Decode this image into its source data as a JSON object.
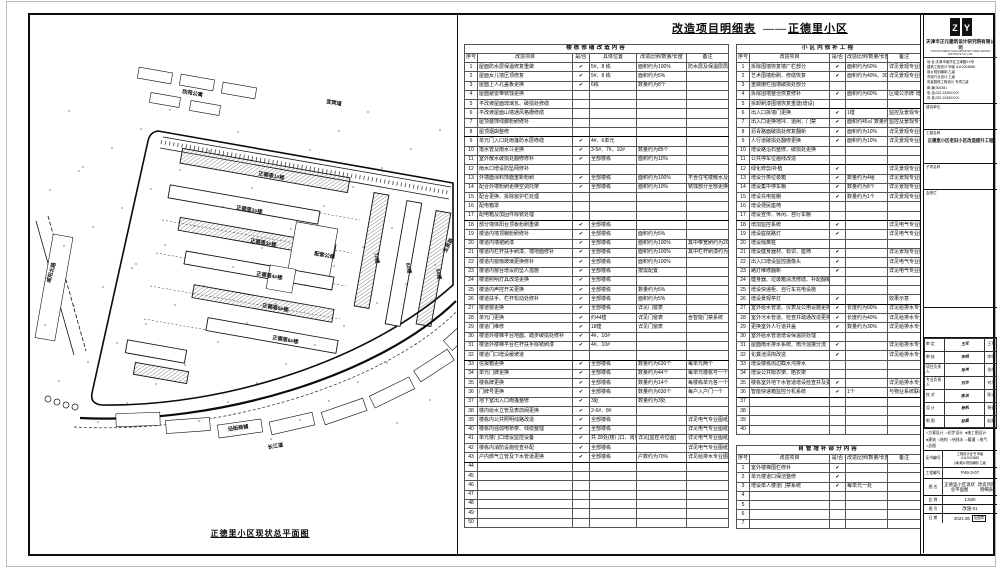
{
  "sheet": {
    "drawing_title": "改造项目明细表",
    "drawing_dash": "——",
    "drawing_subtitle": "正德里小区",
    "map_caption": "正德里小区现状总平面图"
  },
  "left_table": {
    "title": "楼栋修缮改造内容",
    "headers": [
      "序号",
      "改造项目",
      "是/否",
      "具体位置",
      "改造比例/数量/长度",
      "备注"
    ],
    "heavy_after": [
      8,
      17,
      32,
      43
    ],
    "rows": [
      [
        "1",
        "屋面防水层保温修复重做",
        1,
        "5#、8 栋",
        "面积约为100%",
        "防水层及保温层局部重做"
      ],
      [
        "2",
        "屋面女儿墙压顶修复",
        1,
        "5#、8 栋",
        "面积约为5%",
        ""
      ],
      [
        "3",
        "屋面上人孔盖板更换",
        1,
        "6栋",
        "数量约为8个",
        ""
      ],
      [
        "4",
        "屋面避雷带锈蚀更换",
        0,
        "",
        "",
        ""
      ],
      [
        "5",
        "平改坡屋面琉璃瓦、破损处修缮",
        0,
        "",
        "",
        ""
      ],
      [
        "6",
        "平改坡屋面山墙通风格栅修缮",
        0,
        "",
        "",
        ""
      ],
      [
        "7",
        "屋顶装饰线脚粉刷修补",
        0,
        "",
        "",
        ""
      ],
      [
        "8",
        "屋顶烟囱整修",
        0,
        "",
        "",
        ""
      ],
      [
        "9",
        "单元门入口处雨篷防水层修缮",
        1,
        "4#、6单元",
        "",
        ""
      ],
      [
        "10",
        "落水管及雨水斗更换",
        1,
        "3-5#、7#、10#",
        "数量约为85个",
        ""
      ],
      [
        "11",
        "室外散水破损处翻修修补",
        1,
        "全部楼栋",
        "面积约为10%",
        ""
      ],
      [
        "12",
        "雨水口增设防坠网修补",
        0,
        "",
        "",
        ""
      ],
      [
        "13",
        "外墙面涂料饰面重新粉刷",
        1,
        "全部楼栋",
        "面积约为100%",
        "不含住宅楼散水及外窗口"
      ],
      [
        "14",
        "配合外墙粉刷更换空调托架",
        1,
        "全部楼栋",
        "面积约为10%",
        "锈蚀部分全部更换"
      ],
      [
        "15",
        "配合更换、拆除窗护栏处理",
        0,
        "",
        "",
        ""
      ],
      [
        "16",
        "配电箱罩",
        0,
        "",
        "",
        ""
      ],
      [
        "17",
        "配电箱及加固件除锈处理",
        0,
        "",
        "",
        ""
      ],
      [
        "18",
        "部分墙体阳台顶板粉刷重做",
        1,
        "全部楼栋",
        "",
        ""
      ],
      [
        "19",
        "楼道内墙顶棚粉刷修补",
        1,
        "全部楼栋",
        "面积约为5%",
        ""
      ],
      [
        "20",
        "楼道内墙裙刷漆",
        1,
        "全部楼栋",
        "面积约为100%",
        "其中带宽刷约为20%"
      ],
      [
        "21",
        "楼道内栏杆扶手刷漆、墙地面修补",
        1,
        "全部楼栋",
        "面积约为100%",
        "其中栏杆刷漆约为20%"
      ],
      [
        "22",
        "楼道内窗扇玻璃更换修补",
        1,
        "全部楼栋",
        "面积约为100%",
        ""
      ],
      [
        "23",
        "楼道内窗台增设防坠人措施",
        1,
        "全部楼栋",
        "按需配置",
        ""
      ],
      [
        "24",
        "楼道照明灯具改造更换",
        1,
        "全部楼栋",
        "",
        ""
      ],
      [
        "25",
        "楼道内声控开关更换",
        1,
        "全部楼栋",
        "数量约为5%",
        ""
      ],
      [
        "26",
        "楼道扶手、栏杆松动处修补",
        1,
        "全部楼栋",
        "面积约为5%",
        ""
      ],
      [
        "27",
        "楼道窗更换",
        1,
        "全部楼栋",
        "详见门窗表",
        ""
      ],
      [
        "28",
        "单元门更换",
        1,
        "约44樘",
        "详见门窗表",
        "含智能门禁系统"
      ],
      [
        "29",
        "楼道门维修",
        1,
        "18樘",
        "详见门窗表",
        ""
      ],
      [
        "30",
        "楼道外楼梯平台地面、踏步破损处修补",
        1,
        "4#、10#",
        "",
        ""
      ],
      [
        "31",
        "楼道外楼梯平台栏杆扶手除锈刷漆",
        1,
        "4#、10#",
        "",
        ""
      ],
      [
        "32",
        "楼道门口增设缓坡道",
        0,
        "",
        "",
        ""
      ],
      [
        "33",
        "信报箱更换",
        1,
        "全部楼栋",
        "数量约为630个",
        "每单元两个"
      ],
      [
        "34",
        "单元门牌更换",
        1,
        "全部楼栋",
        "数量约为44个",
        "每单元楼栋号一个"
      ],
      [
        "35",
        "楼栋牌更换",
        1,
        "全部楼栋",
        "数量约为14个",
        "每楼栋单元各一个"
      ],
      [
        "36",
        "门牌号更换",
        1,
        "全部楼栋",
        "数量约为630个",
        "每户入户门一个"
      ],
      [
        "37",
        "地下室出入口雨篷整修",
        1,
        "3处",
        "数量约为3处",
        ""
      ],
      [
        "38",
        "楼内给水立管及表前阀更换",
        1,
        "2-6#、8#",
        "",
        ""
      ],
      [
        "39",
        "楼栋内公共照明线路改造",
        1,
        "全部楼栋",
        "",
        "详见电气专业图纸"
      ],
      [
        "40",
        "楼栋内强弱电桥架、线缆整理",
        1,
        "全部楼栋",
        "",
        "详见电气专业图纸"
      ],
      [
        "41",
        "单元楼门口增设监控设备",
        1,
        "共 28处(楼门口、周界)",
        "详见[监控点位图]",
        "详见电气专业图纸"
      ],
      [
        "42",
        "楼栋内消防设施检查补配",
        1,
        "全部楼栋",
        "",
        "详见电气专业图纸"
      ],
      [
        "43",
        "户内燃气立管及下水管道更换",
        1,
        "全部楼栋",
        "户数约为70%",
        "详见给排水专业图纸"
      ],
      [
        "44",
        "",
        0,
        "",
        "",
        ""
      ],
      [
        "45",
        "",
        0,
        "",
        "",
        ""
      ],
      [
        "46",
        "",
        0,
        "",
        "",
        ""
      ],
      [
        "47",
        "",
        0,
        "",
        "",
        ""
      ],
      [
        "48",
        "",
        0,
        "",
        "",
        ""
      ],
      [
        "49",
        "",
        0,
        "",
        "",
        ""
      ],
      [
        "50",
        "",
        0,
        "",
        "",
        ""
      ]
    ]
  },
  "right_table": {
    "title": "小区内修补工程",
    "headers": [
      "序号",
      "改造项目",
      "是/否",
      "改造比例/数量/长度",
      "备注"
    ],
    "heavy_after": [
      5,
      11,
      17,
      26,
      36
    ],
    "rows": [
      [
        "1",
        "拆除围墙恢复墙厂栏部分",
        1,
        "面积约为50%",
        "详见景观专业图纸"
      ],
      [
        "2",
        "艺术围墙粉刷、修缮恢复",
        1,
        "面积约为40%、30%",
        "详见景观专业图纸"
      ],
      [
        "3",
        "重做栅栏围墙破损处部分",
        0,
        "",
        ""
      ],
      [
        "4",
        "拆除围墙整治恢复修补",
        1,
        "面积约为60%",
        "区域公示牌·增"
      ],
      [
        "5",
        "拆卸刷漆围墙恢复重建(增设)",
        0,
        "",
        ""
      ],
      [
        "6",
        "出入口拆墙门更换",
        1,
        "1樘",
        "监控及景观专业图纸"
      ],
      [
        "7",
        "出入口更换地坪、道闸、门禁",
        1,
        "面积约45㎡ 数量约2处",
        "监控及景观专业图纸"
      ],
      [
        "8",
        "沥青路面破损处修复翻新",
        1,
        "面积约为10%",
        "详见景观专业图纸"
      ],
      [
        "9",
        "人行道破损处翻修更换",
        1,
        "面积约为10%",
        "详见景观专业图纸"
      ],
      [
        "10",
        "增设路沿石整修、破损处更换",
        0,
        "",
        ""
      ],
      [
        "11",
        "公共停车位画线改造",
        0,
        "",
        ""
      ],
      [
        "12",
        "绿化修剪/补植",
        1,
        "",
        "详见景观专业图纸"
      ],
      [
        "13",
        "增设分类垃圾箱",
        1,
        "数量约为4组",
        "详见景观专业图纸"
      ],
      [
        "14",
        "增设集中停车棚",
        1,
        "数量约为8个",
        "详见景观专业图纸"
      ],
      [
        "15",
        "增设充电桩棚",
        1,
        "数量约为1个",
        "详见景观专业图纸"
      ],
      [
        "16",
        "增设便民座椅",
        0,
        "",
        ""
      ],
      [
        "17",
        "增设宣传、休闲、自行车棚",
        0,
        "",
        ""
      ],
      [
        "18",
        "增加监控系统",
        1,
        "",
        "详见电气专业图纸"
      ],
      [
        "19",
        "增设庭院路灯",
        1,
        "",
        "详见电气专业图纸"
      ],
      [
        "20",
        "增设隔离桩",
        0,
        "",
        ""
      ],
      [
        "21",
        "增设健身器材、标识、座椅",
        1,
        "",
        "详见景观专业图纸"
      ],
      [
        "22",
        "出入口增设监控摄像头",
        1,
        "",
        "详见电气专业图纸"
      ],
      [
        "23",
        "路灯维修翻新",
        1,
        "",
        "详见电气专业图纸"
      ],
      [
        "24",
        "健身器、垃圾箱清洗修缮、补配翻新",
        0,
        "",
        ""
      ],
      [
        "25",
        "增设快递柜、自行车充电设施",
        0,
        "",
        ""
      ],
      [
        "26",
        "增设景观亭灯",
        1,
        "",
        "效果示意"
      ],
      [
        "27",
        "室外给水管道、仪表及公用设施更换",
        1,
        "长度约为60%",
        "详见给排水专业图纸"
      ],
      [
        "28",
        "室外污水管道、检查井疏通改造更换",
        1,
        "长度约为40%",
        "详见给排水专业图纸"
      ],
      [
        "29",
        "更换室外人行道井盖",
        1,
        "数量约为30%",
        "详见给排水专业图纸"
      ],
      [
        "30",
        "室外给水管道增设保温层处理",
        0,
        "",
        ""
      ],
      [
        "31",
        "屋面雨水排水系统、雨污混接分流",
        1,
        "",
        "详见给排水专业图纸"
      ],
      [
        "32",
        "化粪池清掏改造",
        1,
        "",
        "详见给排水专业图纸"
      ],
      [
        "33",
        "增设楼栋周边截水沟排水",
        0,
        "",
        ""
      ],
      [
        "34",
        "增设公共晾衣架、晒衣架",
        0,
        "",
        ""
      ],
      [
        "35",
        "楼栋室外地下水管道增设检查井及更换",
        1,
        "",
        "详见给排水专业图纸"
      ],
      [
        "36",
        "智能快递箱监控分机系统",
        1,
        "1个",
        "与物业系统联动 2021.06.24"
      ],
      [
        "37",
        "",
        0,
        "",
        ""
      ],
      [
        "38",
        "",
        0,
        "",
        ""
      ],
      [
        "39",
        "",
        0,
        "",
        ""
      ],
      [
        "40",
        "",
        0,
        "",
        ""
      ]
    ]
  },
  "extra_table": {
    "title": "自管增补部分内容",
    "headers": [
      "序号",
      "改造项目",
      "是/否",
      "改造比例/数量/长度",
      "备注"
    ],
    "heavy_after": [],
    "rows": [
      [
        "1",
        "室外楼梯围栏修补",
        1,
        "",
        ""
      ],
      [
        "2",
        "单元楼道口保洁整修",
        1,
        "",
        ""
      ],
      [
        "3",
        "增设单人楼道门禁系统",
        1,
        "每单元一处",
        ""
      ],
      [
        "4",
        "",
        0,
        "",
        ""
      ],
      [
        "5",
        "",
        0,
        "",
        ""
      ],
      [
        "6",
        "",
        0,
        "",
        ""
      ],
      [
        "7",
        "",
        0,
        "",
        ""
      ]
    ]
  },
  "map": {
    "labels": [
      {
        "t": "宜宾道",
        "x": 296,
        "y": 88,
        "r": 10
      },
      {
        "t": "咸阳北路",
        "x": 20,
        "y": 268,
        "r": -74
      },
      {
        "t": "长江道",
        "x": 238,
        "y": 434,
        "r": -10
      },
      {
        "t": "玉泉路",
        "x": 416,
        "y": 238,
        "r": -62
      },
      {
        "t": "正德里1#楼",
        "x": 228,
        "y": 160,
        "r": 10
      },
      {
        "t": "正德里2#楼",
        "x": 206,
        "y": 194,
        "r": 10
      },
      {
        "t": "正德里3#楼",
        "x": 220,
        "y": 227,
        "r": 10
      },
      {
        "t": "正德里4#楼",
        "x": 226,
        "y": 260,
        "r": 10
      },
      {
        "t": "正德里5#楼",
        "x": 232,
        "y": 292,
        "r": 10
      },
      {
        "t": "正德里6#楼",
        "x": 242,
        "y": 324,
        "r": 10
      },
      {
        "t": "7#楼",
        "x": 344,
        "y": 238,
        "r": 80
      },
      {
        "t": "8#楼",
        "x": 376,
        "y": 248,
        "r": 80
      },
      {
        "t": "9#楼",
        "x": 406,
        "y": 254,
        "r": 80
      },
      {
        "t": "配套公建",
        "x": 284,
        "y": 240,
        "r": 10
      },
      {
        "t": "欣苑公寓",
        "x": 152,
        "y": 78,
        "r": 10
      },
      {
        "t": "沿街商铺",
        "x": 198,
        "y": 416,
        "r": -8
      }
    ]
  },
  "title_block": {
    "company": "天津市正元建筑设计研究院有限公司",
    "company_en": "TIANJIN ZHENGYUAN ARCHITECTURAL DESIGN INSTITUTE CO.,LTD.",
    "contact_lines": [
      "地 址:天津市南开区卫津路XX号",
      "建筑工程设计 甲级 A112003688",
      "城乡规划编制 乙级",
      "市政行业设计 乙级",
      "风景园林工程设计 专项乙级",
      "邮 编:300381",
      "电 话:022-2345XXXX",
      "传 真:022-2345XXXX"
    ],
    "sections": [
      {
        "label": "建设单位",
        "value": ""
      },
      {
        "label": "工程名称",
        "value": "正德里小区老旧小区改造提升工程"
      },
      {
        "label": "子项名称",
        "value": ""
      },
      {
        "label": "会签栏",
        "value": ""
      },
      {
        "label": "",
        "value": ""
      }
    ],
    "signature_rows": [
      {
        "label": "审 定",
        "sign": "王军",
        "print": "王军"
      },
      {
        "label": "审 核",
        "sign": "李明",
        "print": "李明"
      },
      {
        "label": "项目负责人",
        "sign": "张伟",
        "print": "张伟"
      },
      {
        "label": "专业负责人",
        "sign": "刘华",
        "print": "刘华"
      },
      {
        "label": "校 对",
        "sign": "陈洁",
        "print": "陈洁"
      },
      {
        "label": "设 计",
        "sign": "杨帆",
        "print": "杨帆"
      },
      {
        "label": "制 图",
        "sign": "赵磊",
        "print": "赵磊"
      }
    ],
    "options_phase": [
      {
        "label": "方案设计",
        "checked": false
      },
      {
        "label": "初步设计",
        "checked": false
      },
      {
        "label": "施工图设计",
        "checked": true
      }
    ],
    "options_discipline": [
      {
        "label": "建筑",
        "checked": true
      },
      {
        "label": "结构",
        "checked": false
      },
      {
        "label": "给排水",
        "checked": false
      },
      {
        "label": "暖通",
        "checked": false
      },
      {
        "label": "电气",
        "checked": false
      },
      {
        "label": "总图",
        "checked": false
      }
    ],
    "cert": {
      "label": "证书编号",
      "lines": [
        "工程设计证书 甲级",
        "A112003688",
        "(津)城乡规划编制 乙级"
      ]
    },
    "project_no": {
      "label": "工程编号",
      "value": "P46-3-07"
    },
    "sheet_name": {
      "label": "图 名",
      "lines": [
        "正德里小区现状总平面图",
        "改造项目明细表"
      ]
    },
    "scale": {
      "label": "比 例",
      "value": "1:500"
    },
    "sheet_no": {
      "label": "图 号",
      "value": "改施-01"
    },
    "date": {
      "label": "日 期",
      "value": "2021.06"
    },
    "stamp": "出图章",
    "logo_text": "正元"
  }
}
